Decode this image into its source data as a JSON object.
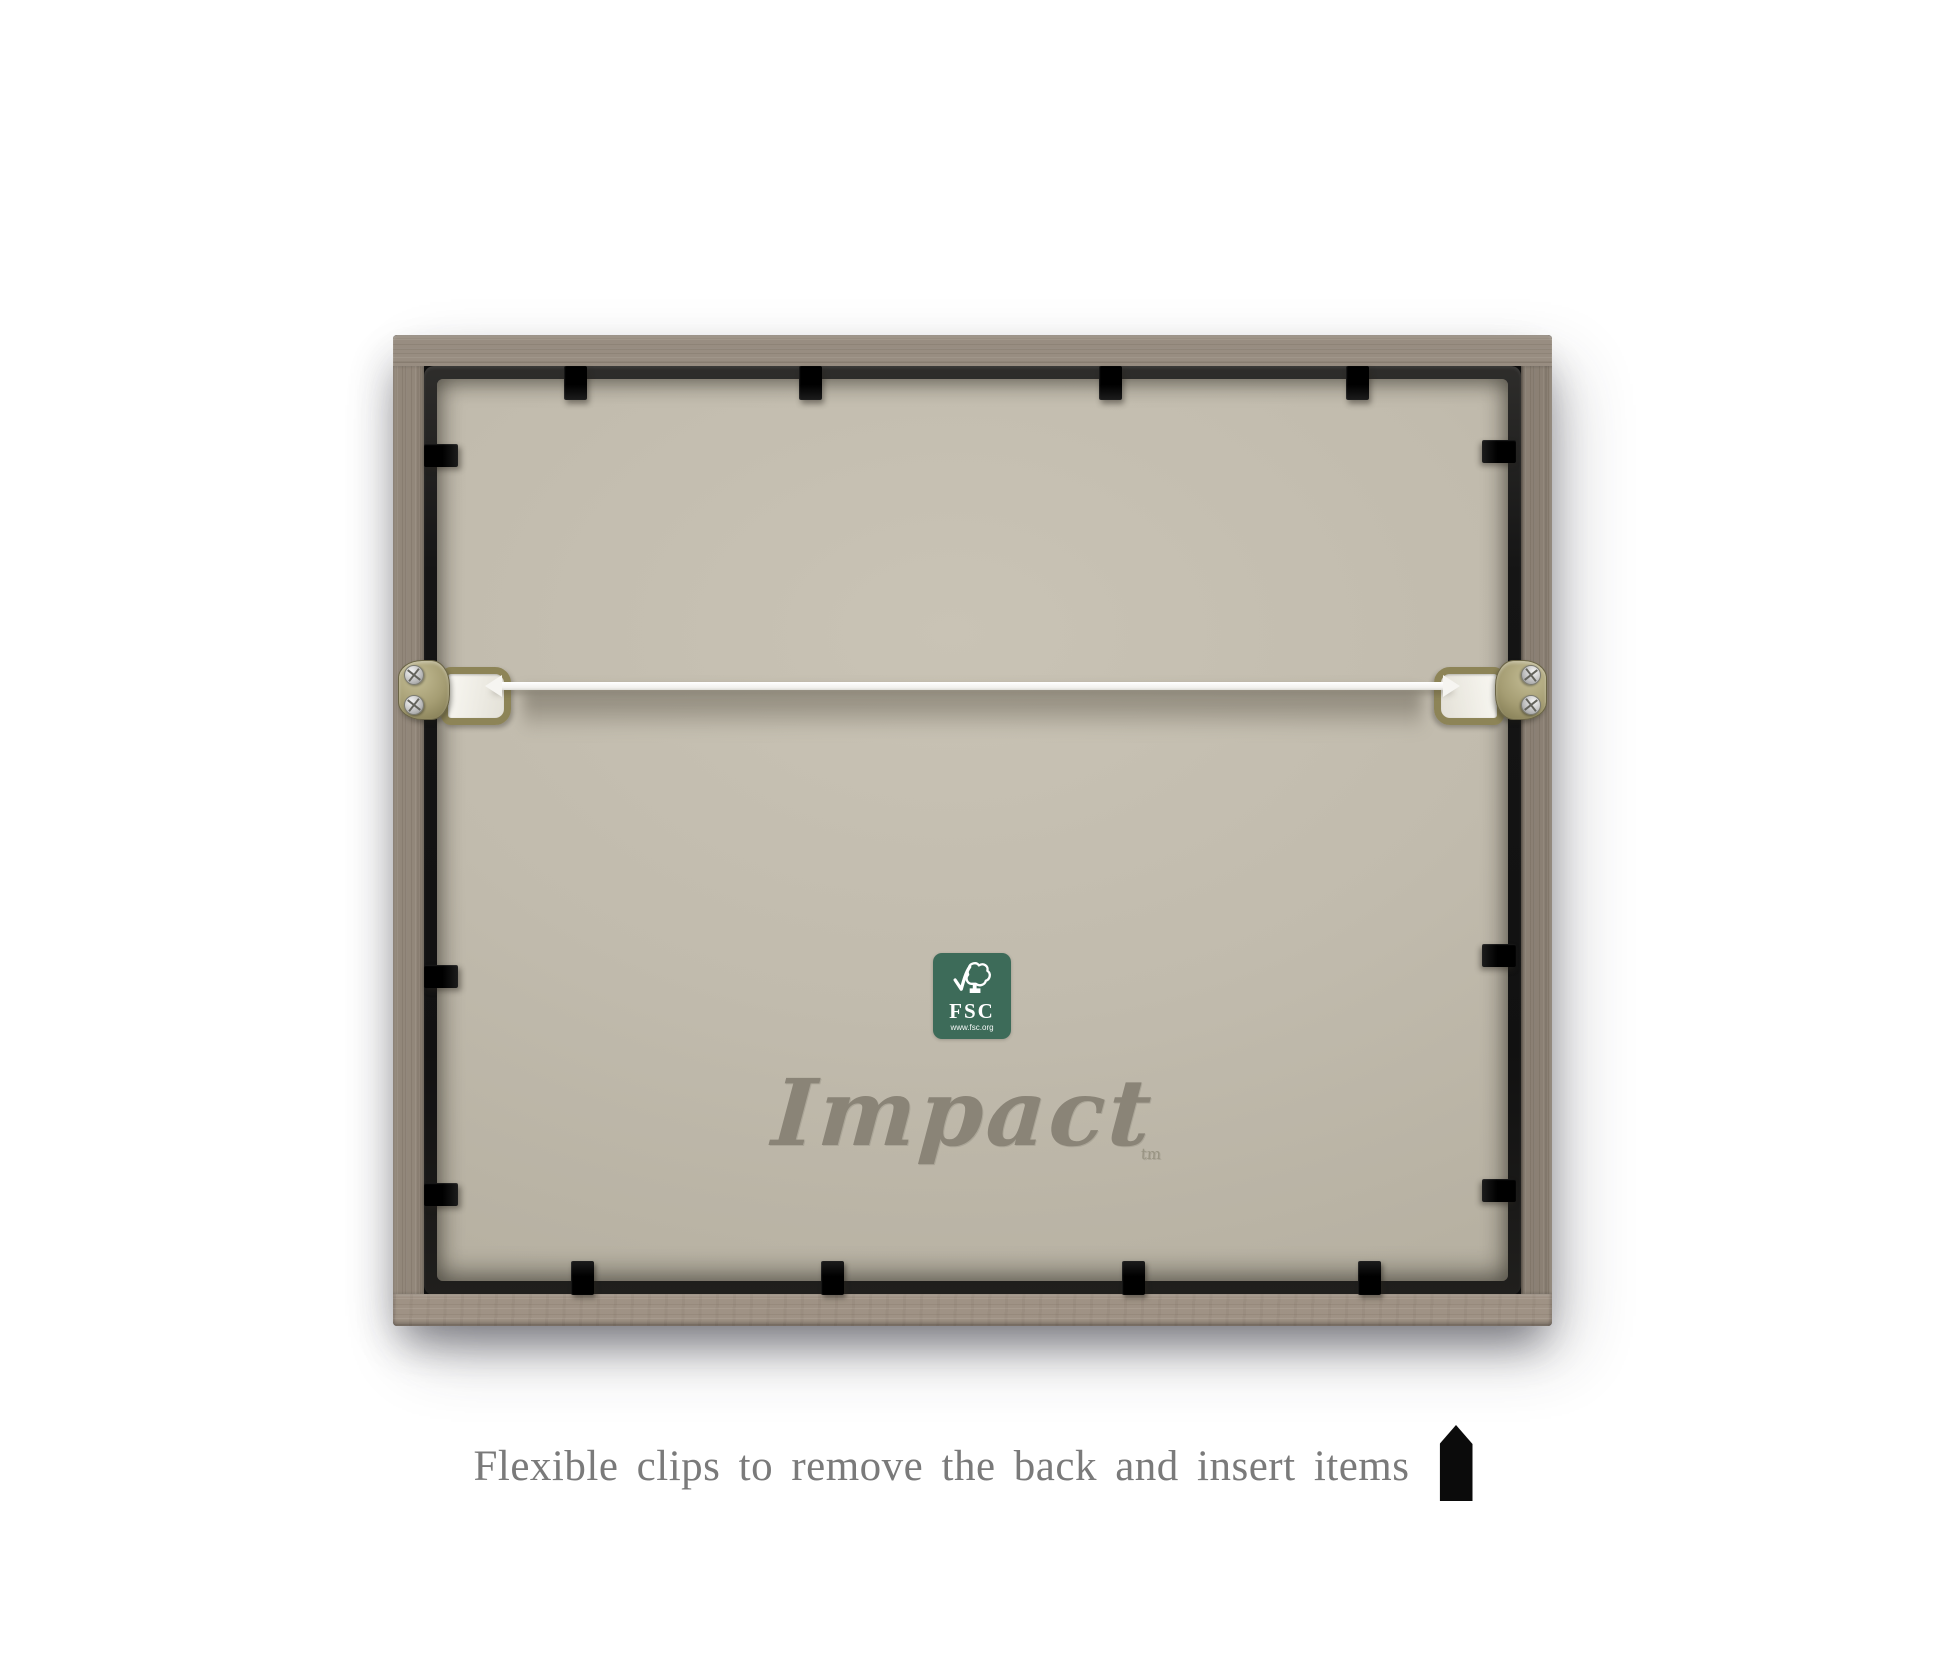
{
  "product_photo": {
    "caption": {
      "text": "Flexible clips to remove the back and insert items"
    },
    "brand": {
      "name": "Impact",
      "trademark": "tm"
    },
    "fsc_label": {
      "acronym": "FSC",
      "url": "www.fsc.org",
      "background": "#3d6b59"
    },
    "frame": {
      "wood_color": "#92877a",
      "rim_color": "#161616",
      "backing_color": "#c1bbad",
      "clip_color": "#0d0d0d",
      "wire_color": "#f2f1ee",
      "clips": {
        "top_x": [
          182,
          417,
          717,
          964
        ],
        "bottom_x": [
          189,
          439,
          740,
          976
        ],
        "left_y": [
          120,
          641,
          859
        ],
        "right_y": [
          116,
          620,
          855
        ]
      }
    }
  }
}
